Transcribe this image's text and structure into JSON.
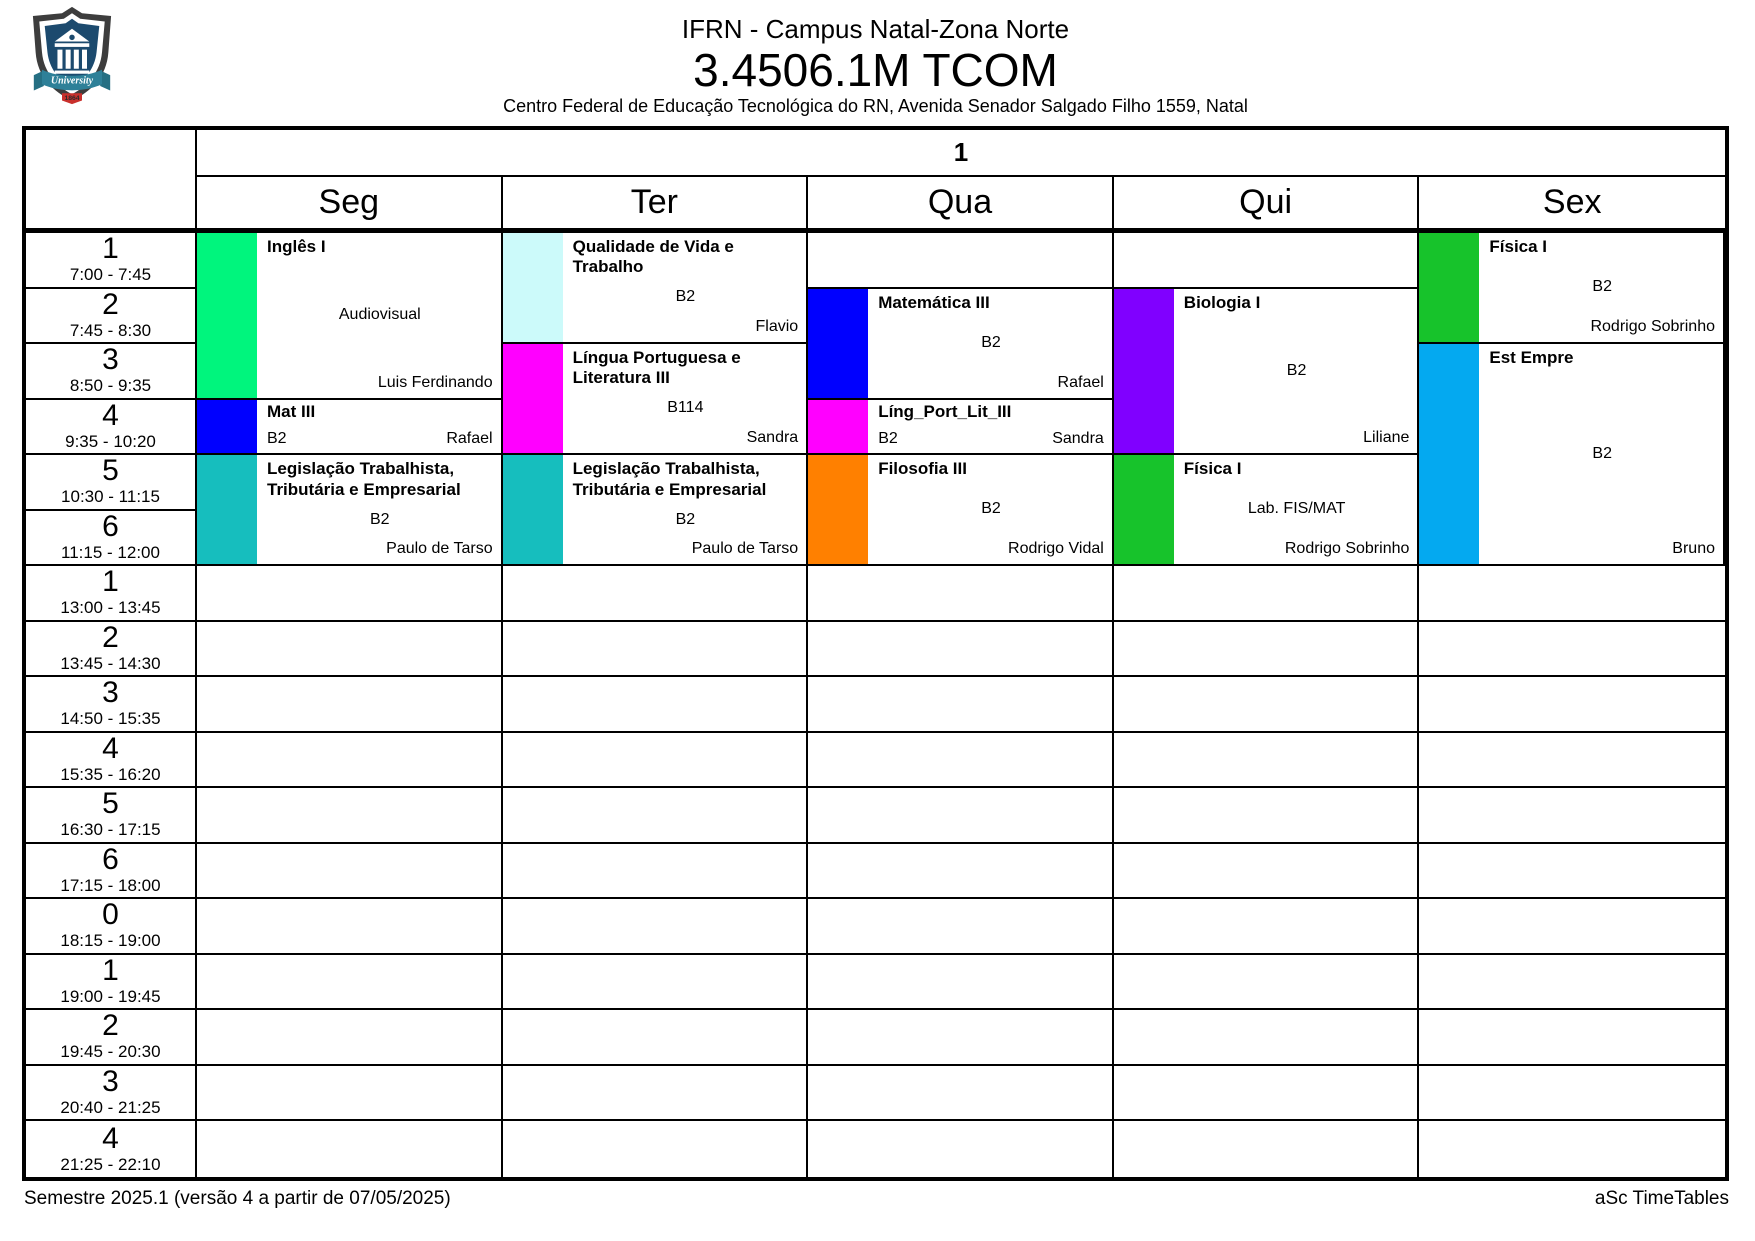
{
  "header": {
    "institution": "IFRN - Campus Natal-Zona Norte",
    "class_name": "3.4506.1M TCOM",
    "address": "Centro Federal de Educação Tecnológica do RN, Avenida Senador Salgado Filho 1559, Natal"
  },
  "logo": {
    "banner_text": "University",
    "year_text": "1864"
  },
  "timetable": {
    "group_header": "1",
    "days": [
      "Seg",
      "Ter",
      "Qua",
      "Qui",
      "Sex"
    ],
    "periods": [
      {
        "num": "1",
        "time": "7:00 - 7:45"
      },
      {
        "num": "2",
        "time": "7:45 - 8:30"
      },
      {
        "num": "3",
        "time": "8:50 - 9:35"
      },
      {
        "num": "4",
        "time": "9:35 - 10:20"
      },
      {
        "num": "5",
        "time": "10:30 - 11:15"
      },
      {
        "num": "6",
        "time": "11:15 - 12:00"
      },
      {
        "num": "1",
        "time": "13:00 - 13:45"
      },
      {
        "num": "2",
        "time": "13:45 - 14:30"
      },
      {
        "num": "3",
        "time": "14:50 - 15:35"
      },
      {
        "num": "4",
        "time": "15:35 - 16:20"
      },
      {
        "num": "5",
        "time": "16:30 - 17:15"
      },
      {
        "num": "6",
        "time": "17:15 - 18:00"
      },
      {
        "num": "0",
        "time": "18:15 - 19:00"
      },
      {
        "num": "1",
        "time": "19:00 - 19:45"
      },
      {
        "num": "2",
        "time": "19:45 - 20:30"
      },
      {
        "num": "3",
        "time": "20:40 - 21:25"
      },
      {
        "num": "4",
        "time": "21:25 - 22:10"
      }
    ],
    "blocks": [
      {
        "day": 0,
        "start": 1,
        "span": 3,
        "color": "#00F57D",
        "title": "Inglês I",
        "room": "Audiovisual",
        "teacher": "Luis Ferdinando",
        "layout": "tall"
      },
      {
        "day": 0,
        "start": 4,
        "span": 1,
        "color": "#0000FF",
        "title": "Mat III",
        "room": "B2",
        "teacher": "Rafael",
        "layout": "compact"
      },
      {
        "day": 0,
        "start": 5,
        "span": 2,
        "color": "#16BEBE",
        "title": "Legislação Trabalhista, Tributária e Empresarial",
        "room": "B2",
        "teacher": "Paulo de Tarso",
        "layout": "tall"
      },
      {
        "day": 1,
        "start": 1,
        "span": 2,
        "color": "#CCFAFA",
        "title": "Qualidade de Vida e Trabalho",
        "room": "B2",
        "teacher": "Flavio",
        "layout": "tall"
      },
      {
        "day": 1,
        "start": 3,
        "span": 2,
        "color": "#FF00FF",
        "title": "Língua Portuguesa e Literatura III",
        "room": "B114",
        "teacher": "Sandra",
        "layout": "tall"
      },
      {
        "day": 1,
        "start": 5,
        "span": 2,
        "color": "#16BEBE",
        "title": "Legislação Trabalhista, Tributária e Empresarial",
        "room": "B2",
        "teacher": "Paulo de Tarso",
        "layout": "tall"
      },
      {
        "day": 2,
        "start": 2,
        "span": 2,
        "color": "#0000FF",
        "title": "Matemática III",
        "room": "B2",
        "teacher": "Rafael",
        "layout": "tall"
      },
      {
        "day": 2,
        "start": 4,
        "span": 1,
        "color": "#FF00FF",
        "title": "Líng_Port_Lit_III",
        "room": "B2",
        "teacher": "Sandra",
        "layout": "compact"
      },
      {
        "day": 2,
        "start": 5,
        "span": 2,
        "color": "#FF8000",
        "title": "Filosofia III",
        "room": "B2",
        "teacher": "Rodrigo Vidal",
        "layout": "tall"
      },
      {
        "day": 3,
        "start": 2,
        "span": 3,
        "color": "#8000FF",
        "title": "Biologia I",
        "room": "B2",
        "teacher": "Liliane",
        "layout": "tall"
      },
      {
        "day": 3,
        "start": 5,
        "span": 2,
        "color": "#17C32B",
        "title": "Física I",
        "room": "Lab. FIS/MAT",
        "teacher": "Rodrigo Sobrinho",
        "layout": "tall"
      },
      {
        "day": 4,
        "start": 1,
        "span": 2,
        "color": "#17C32B",
        "title": "Física I",
        "room": "B2",
        "teacher": "Rodrigo Sobrinho",
        "layout": "tall"
      },
      {
        "day": 4,
        "start": 3,
        "span": 4,
        "color": "#04A9F0",
        "title": "Est Empre",
        "room": "B2",
        "teacher": "Bruno",
        "layout": "tall"
      }
    ]
  },
  "footer": {
    "left": "Semestre 2025.1 (versão 4 a partir de 07/05/2025)",
    "right": "aSc TimeTables"
  }
}
